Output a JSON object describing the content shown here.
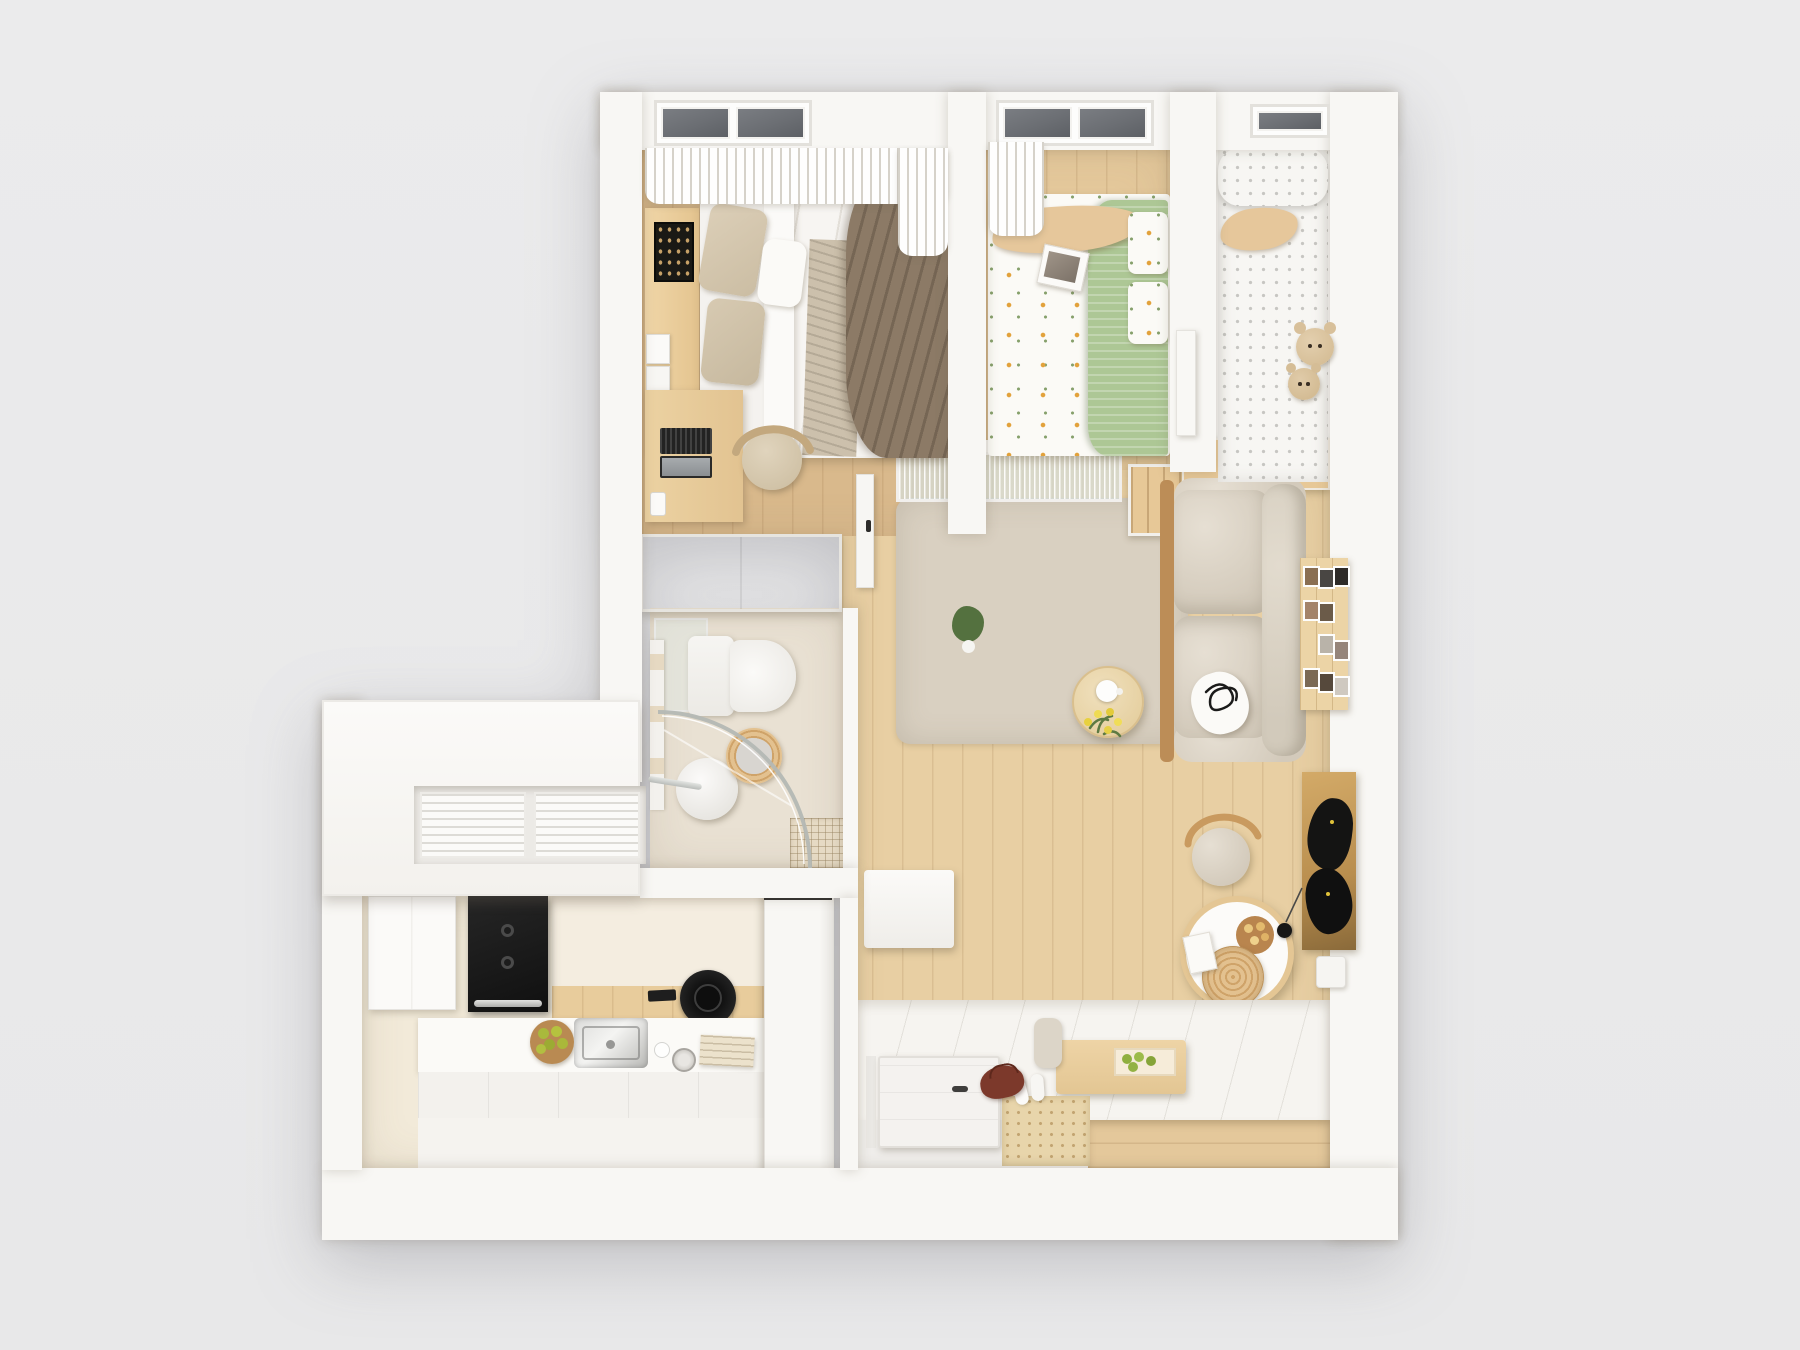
{
  "scene": {
    "kind": "apartment-floor-plan-3d-top-down-render",
    "background_color": "#e9e9ea",
    "rooms": [
      {
        "name": "master-bedroom",
        "furniture": [
          "double-bed",
          "beige-pillows",
          "white-duvet",
          "brown-throw-blanket",
          "headboard-shelf",
          "black-wall-art",
          "light-switches",
          "desk",
          "laptop",
          "smartphone",
          "desk-chair",
          "wardrobe-cabinet",
          "sheer-curtains",
          "skylight-windows"
        ]
      },
      {
        "name": "kids-bedroom",
        "furniture": [
          "bed-floral-sheets",
          "green-blanket",
          "wavy-plush-pillow",
          "open-magazine",
          "floral-pillows",
          "sheer-curtain",
          "skylight-windows",
          "white-door"
        ]
      },
      {
        "name": "nursery-nook",
        "furniture": [
          "polka-dot-crib-mattress",
          "bolster-pillow",
          "wavy-plush-pillow",
          "teddy-bears",
          "stepped-wood-cabinet",
          "skylight-window"
        ]
      },
      {
        "name": "bathroom",
        "furniture": [
          "toilet",
          "curved-glass-shower",
          "shower-stool",
          "chrome-towel-rail",
          "rattan-towel-basket",
          "drain-mat",
          "glass-partition",
          "wall-shelf"
        ]
      },
      {
        "name": "living-room",
        "furniture": [
          "fabric-sofa-wood-frame",
          "scribble-art-pillow",
          "area-rug",
          "round-coffee-table",
          "white-teapot",
          "tulip-bouquet",
          "wood-shelf-cabinet",
          "photo-gallery-board",
          "potted-plant",
          "sliding-ribbed-glass-door",
          "interior-door"
        ]
      },
      {
        "name": "dining-corner",
        "furniture": [
          "round-dining-table",
          "wood-serving-plate",
          "cookies",
          "rattan-hat",
          "book",
          "dining-chair",
          "cat-wall-art",
          "cat-teaser-ball"
        ]
      },
      {
        "name": "entryway",
        "furniture": [
          "front-door",
          "perforated-entry-mat",
          "white-slippers",
          "leather-bag",
          "storage-platform",
          "platform-drawer-front",
          "low-wood-table",
          "green-fruit-tray",
          "floor-cushion",
          "storage-box-seat"
        ]
      },
      {
        "name": "kitchen",
        "furniture": [
          "refrigerator",
          "built-in-black-oven",
          "induction-hob",
          "remote",
          "stainless-sink",
          "fruit-plate-green-apples",
          "glass-cup",
          "metal-jar",
          "cutting-boards",
          "pocket-sliding-door",
          "louvered-utility-windows"
        ]
      }
    ]
  },
  "palette": {
    "bg": "#e9e9ea",
    "wall": "#f8f7f4",
    "wallShade": "#eceae6",
    "wallEdge": "#e3e1dc",
    "woodMaster": "#d9b98c",
    "woodKid": "#e4c89b",
    "woodLiving": "#e8cfa3",
    "woodAccent": "#e7c897",
    "woodDark": "#bc8d57",
    "woodPale": "#eedcb7",
    "rug": "#d9d0c1",
    "bathFloor": "#e9e1d3",
    "kitchenFloor": "#f2ead9",
    "stone": "#f4ede0",
    "sofa": "#d9d1c3",
    "sofaShade": "#cfc6b7",
    "cushion": "#d5c8b0",
    "duvet": "#f4f2ef",
    "throw": "#8c7a66",
    "runner": "#ccc0ac",
    "greenBlanket": "#adc795",
    "plush": "#e6c79b",
    "polka": "#f7f6f3",
    "black": "#181817",
    "steel": "#c9c9c6",
    "glass": "#dfe7e3",
    "apple": "#a9b93c",
    "mat": "#e8d5ab",
    "bag": "#7c392b",
    "catBoard": "#c79d5e",
    "windowGlass": "#6b6e73",
    "curtain": "#f5f3ef",
    "white": "#fcfbfa"
  }
}
